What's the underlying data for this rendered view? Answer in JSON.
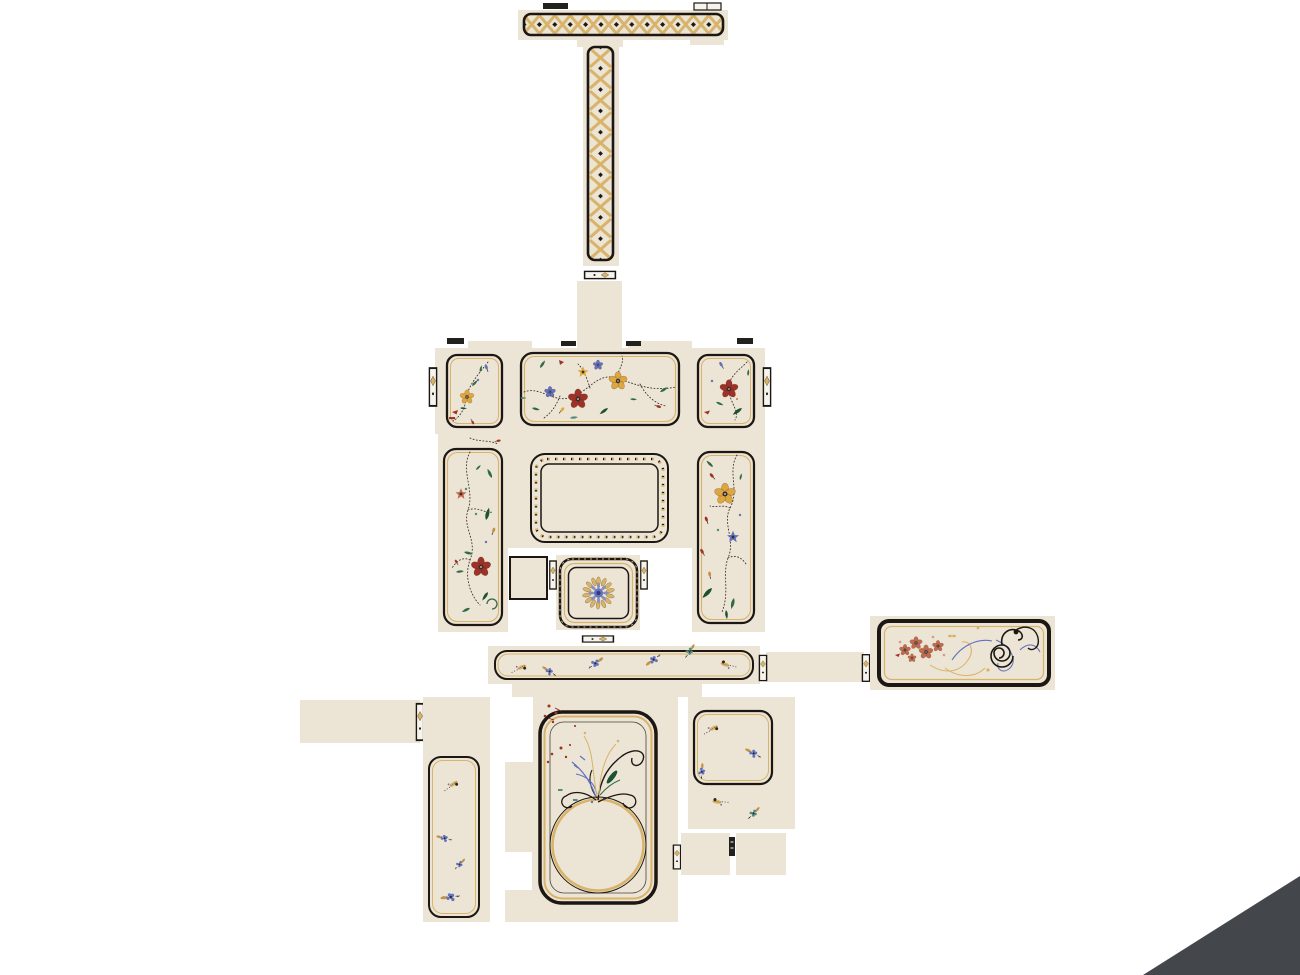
{
  "canvas": {
    "width": 1300,
    "height": 975,
    "background": "#ffffff"
  },
  "palette": {
    "bg": "#ffffff",
    "cream": "#ece4d4",
    "pale": "#f7f4ee",
    "ink": "#1c1712",
    "gold": "#c29244",
    "goldlight": "#d8b36a",
    "yellow": "#dda73e",
    "red": "#9e3226",
    "blue": "#6272bd",
    "navy": "#2c3a78",
    "green": "#2f6b45",
    "greendark": "#1c5233",
    "teal": "#4e8b80",
    "coral": "#bf6b4e",
    "mark": "#23211d",
    "triangle": "#43474c"
  },
  "pieces": {
    "top_rail": {
      "name": "top-rail-lattice",
      "lattice_cells": 13
    },
    "column": {
      "name": "lattice-column",
      "lattice_cells": 10
    },
    "neck_strip": {
      "name": "neck-strip"
    },
    "main_body": {
      "name": "main-body",
      "tick_marks": 4,
      "edge_connectors": 2
    },
    "top_row_panels": {
      "count": 3,
      "names": [
        "left-floral-panel",
        "center-vine-panel",
        "right-floral-panel"
      ]
    },
    "side_columns": {
      "count": 2,
      "names": [
        "left-vine-column",
        "right-vine-column"
      ]
    },
    "center_frame": {
      "name": "ornament-border-frame"
    },
    "rosette_tile": {
      "name": "rosette-tile",
      "outer_petals": 14,
      "inner_petals": 8
    },
    "spacer_square": {
      "name": "spacer-square"
    },
    "floral_bar": {
      "name": "sprig-bar",
      "sprigs": 6
    },
    "right_link_strip": {
      "name": "right-link-strip",
      "connectors": 2
    },
    "scroll_panel": {
      "name": "scrollwork-panel"
    },
    "left_link_strip": {
      "name": "left-link-strip",
      "connectors": 1
    },
    "left_sprig_column": {
      "name": "left-sprig-column",
      "sprigs": 4
    },
    "arch_panel": {
      "name": "arch-circle-panel"
    },
    "sprig_square": {
      "name": "sprig-square-panel",
      "sprigs_inside": 3,
      "sprigs_below": 2
    },
    "lower_right_tabs": {
      "count": 2
    },
    "corner_triangle": {
      "name": "corner-triangle"
    }
  }
}
